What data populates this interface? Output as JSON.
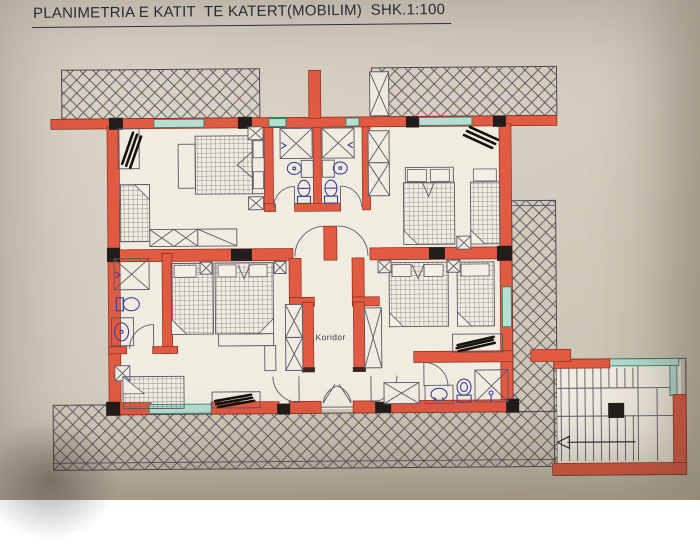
{
  "title": "PLANIMETRIA E KATIT  TE KATERT(MOBILIM)  SHK.1:100",
  "plan": {
    "corridor_label": "Koridor"
  },
  "colors": {
    "photo_bg_light": "#ded8cb",
    "photo_bg": "#d6cfc1",
    "photo_bg_dark": "#c7beae",
    "paper": "#f1ece0",
    "wall": "#e15a42",
    "wall_edge": "#8e2b1c",
    "column": "#211e1b",
    "window": "#b7ded2",
    "window_edge": "#3f7f71",
    "line": "#5a5866",
    "hatch": "#56525c",
    "fixture": "#3d3f9f",
    "title_ink": "#262b3a"
  },
  "elements": {
    "hatched_areas": [
      "balcony-top-left",
      "balcony-top-right",
      "balcony-right",
      "terrace-bottom"
    ],
    "furniture_icons": [
      "double-bed",
      "single-bed",
      "wardrobe",
      "nightstand",
      "shower",
      "toilet",
      "sink",
      "radiator",
      "door-swing",
      "staircase"
    ],
    "stairs_arrow_direction": "left"
  }
}
